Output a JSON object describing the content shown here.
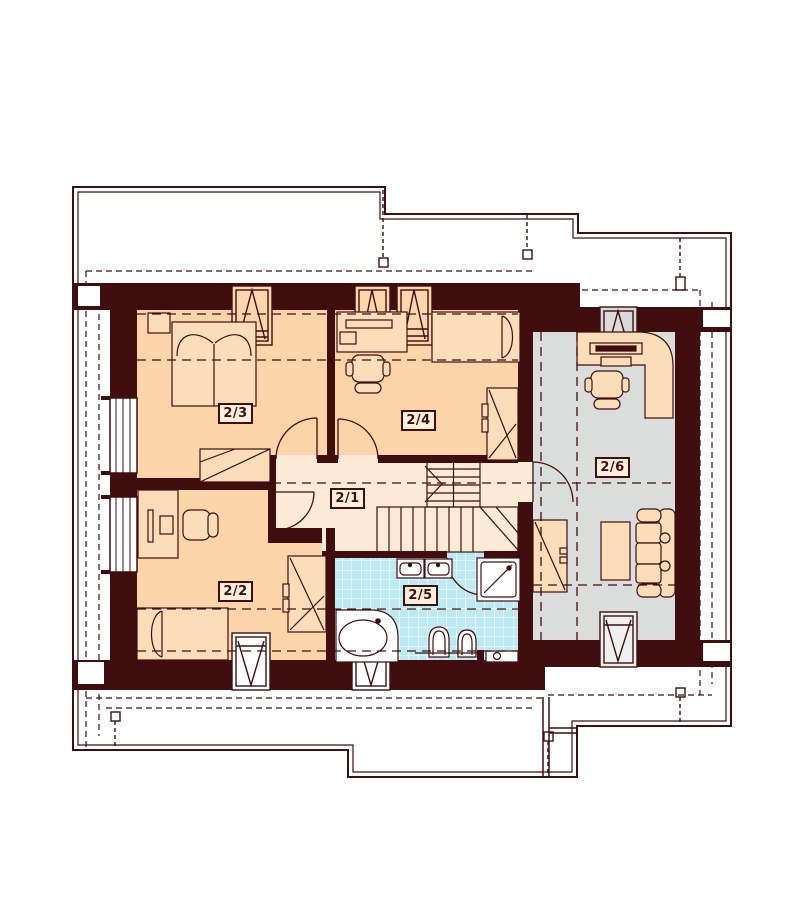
{
  "plan": {
    "type": "architectural-floor-plan",
    "storey_rooms": [
      {
        "label": "2/1",
        "floor_color": "#fcead6"
      },
      {
        "label": "2/2",
        "floor_color": "#fbd5a9"
      },
      {
        "label": "2/3",
        "floor_color": "#fbd5a9"
      },
      {
        "label": "2/4",
        "floor_color": "#fbd5a9"
      },
      {
        "label": "2/5",
        "floor_color": "#bce9f2"
      },
      {
        "label": "2/6",
        "floor_color": "#dbdcdc"
      }
    ],
    "colors": {
      "wall": "#400e0e",
      "line": "#400e0e",
      "bedroom_floor": "#fbd5a9",
      "hall_floor": "#fcead6",
      "bathroom_floor": "#bce9f2",
      "study_floor": "#dbdcdc",
      "furniture_fill": "#fcddb9",
      "fixture_fill": "#ffffff",
      "tile_grid": "#ffffff",
      "label_box_fill": "#fdeedd",
      "background": "#ffffff"
    }
  }
}
